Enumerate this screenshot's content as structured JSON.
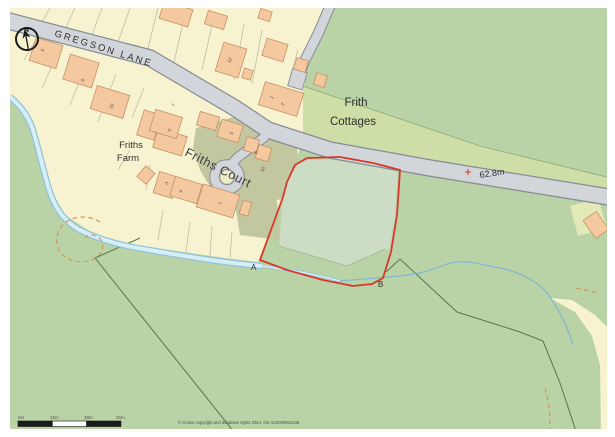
{
  "map": {
    "compass": {
      "north_label": "N"
    },
    "road_labels": {
      "gregson_lane": "GREGSON LANE",
      "friths_court": "Friths Court"
    },
    "place_labels": {
      "frith_cottages_line1": "Frith",
      "frith_cottages_line2": "Cottages",
      "friths_farm_line1": "Friths",
      "friths_farm_line2": "Farm",
      "truncated_left_label": "k"
    },
    "annotations": {
      "spot_height": "62.8m",
      "marker_a": "A",
      "marker_b": "B"
    },
    "house_numbers": [
      "5",
      "6",
      "10",
      "12",
      "1",
      "2",
      "7",
      "5",
      "5",
      "6",
      "10",
      "3",
      "4",
      "1"
    ],
    "scale_bar": {
      "labels": [
        "0m",
        "15m",
        "30m",
        "45m"
      ]
    },
    "attribution": "© Crown copyright and database rights 2024. OS AC0000813448",
    "colors": {
      "field_green": "#b9d3a6",
      "light_green": "#cddfa6",
      "parcel_cream": "#f7f3d0",
      "building_orange": "#f5c99f",
      "building_outline": "#c69066",
      "road_gray": "#d2d5da",
      "road_casing": "#868b94",
      "made_ground_olive": "#c3c7a0",
      "water_blue": "#8fc3da",
      "water_fill": "#d8eef6",
      "plot_boundary_red": "#d8382c",
      "plot_fill": "#cddcc4",
      "contour_orange": "#cf9a55"
    }
  }
}
